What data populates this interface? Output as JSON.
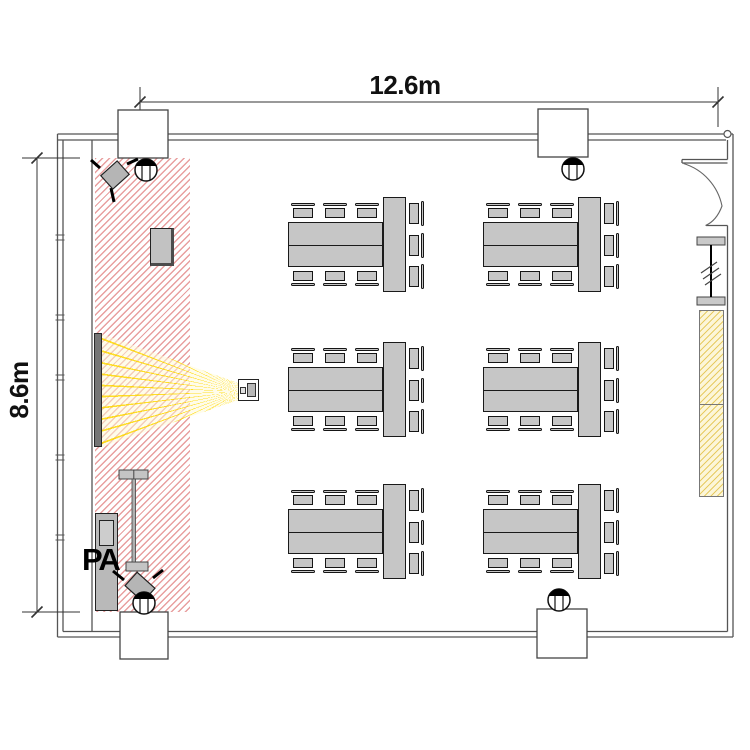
{
  "dimensions": {
    "width_label": "12.6m",
    "height_label": "8.6m"
  },
  "stage": {
    "pa_label": "PA"
  },
  "colors": {
    "hatch_red": "#d65050",
    "hatch_yellow": "#e2c044",
    "beam_yellow": "#ffd800",
    "furniture_gray": "#c6c6c6",
    "wall_gray": "#555555",
    "screen_gray": "#757575"
  },
  "furniture": {
    "table_groups": [
      {
        "x": 288,
        "y": 222
      },
      {
        "x": 483,
        "y": 222
      },
      {
        "x": 288,
        "y": 367
      },
      {
        "x": 483,
        "y": 367
      },
      {
        "x": 288,
        "y": 509
      },
      {
        "x": 483,
        "y": 509
      }
    ],
    "tables_per_group": 3,
    "chairs_per_group": 9,
    "chairs_top_x": [
      3,
      35,
      67
    ],
    "chairs_right_y": [
      -21,
      10.5,
      42
    ]
  },
  "fixtures": {
    "columns": [
      {
        "x": 118,
        "y": 110,
        "w": 50,
        "h": 48
      },
      {
        "x": 538,
        "y": 109,
        "w": 50,
        "h": 48
      },
      {
        "x": 120,
        "y": 612,
        "w": 48,
        "h": 47
      },
      {
        "x": 537,
        "y": 609,
        "w": 50,
        "h": 49
      }
    ],
    "ceiling_speakers": [
      {
        "x": 146,
        "y": 170
      },
      {
        "x": 573,
        "y": 169
      },
      {
        "x": 144,
        "y": 603
      },
      {
        "x": 559,
        "y": 600
      }
    ],
    "window_ticks_y": [
      235,
      315,
      375,
      455,
      535
    ],
    "stand_speakers": 2
  }
}
